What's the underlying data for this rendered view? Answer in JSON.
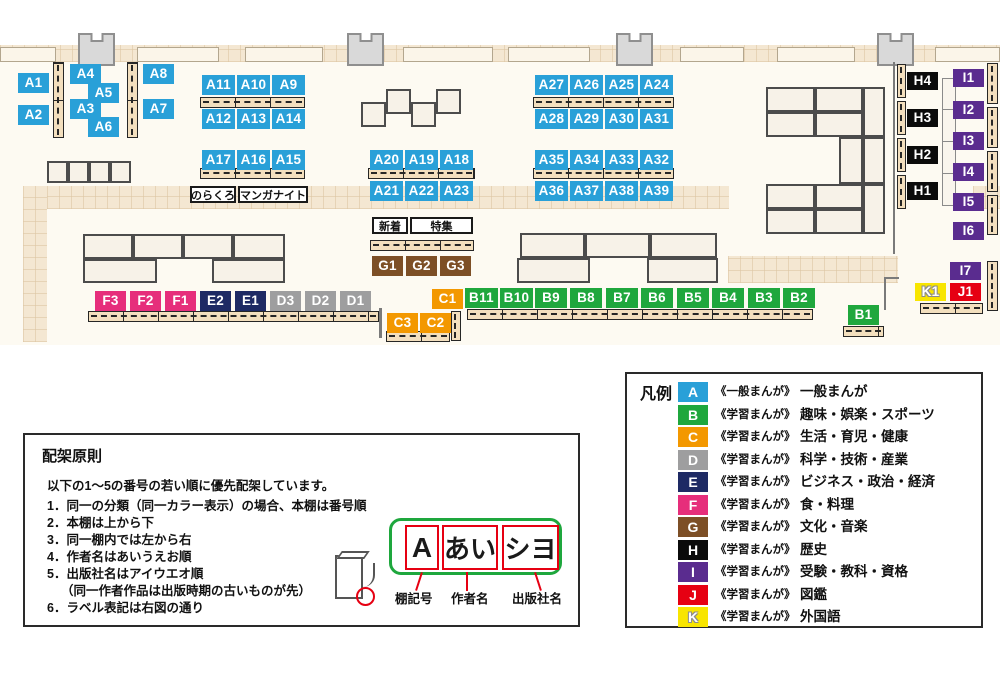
{
  "colors": {
    "A": "#29a0d8",
    "B": "#1fa73d",
    "C": "#f39800",
    "D": "#9e9e9f",
    "E": "#1e2a64",
    "F": "#e62e7b",
    "G": "#7d4f26",
    "H": "#0b0b0b",
    "I": "#5a2c8f",
    "J": "#e60012",
    "K": "#f8e500"
  },
  "map": {
    "markers": [
      {
        "t": "A1",
        "c": "A",
        "x": 18,
        "y": 73
      },
      {
        "t": "A2",
        "c": "A",
        "x": 18,
        "y": 105
      },
      {
        "t": "A4",
        "c": "A",
        "x": 70,
        "y": 64
      },
      {
        "t": "A5",
        "c": "A",
        "x": 88,
        "y": 83
      },
      {
        "t": "A3",
        "c": "A",
        "x": 70,
        "y": 99
      },
      {
        "t": "A6",
        "c": "A",
        "x": 88,
        "y": 117
      },
      {
        "t": "A8",
        "c": "A",
        "x": 143,
        "y": 64
      },
      {
        "t": "A7",
        "c": "A",
        "x": 143,
        "y": 99
      },
      {
        "t": "A11",
        "c": "A",
        "x": 202,
        "y": 75,
        "w": 33
      },
      {
        "t": "A10",
        "c": "A",
        "x": 237,
        "y": 75,
        "w": 33
      },
      {
        "t": "A9",
        "c": "A",
        "x": 272,
        "y": 75,
        "w": 33
      },
      {
        "t": "A12",
        "c": "A",
        "x": 202,
        "y": 109,
        "w": 33
      },
      {
        "t": "A13",
        "c": "A",
        "x": 237,
        "y": 109,
        "w": 33
      },
      {
        "t": "A14",
        "c": "A",
        "x": 272,
        "y": 109,
        "w": 33
      },
      {
        "t": "A17",
        "c": "A",
        "x": 202,
        "y": 150,
        "w": 33
      },
      {
        "t": "A16",
        "c": "A",
        "x": 237,
        "y": 150,
        "w": 33
      },
      {
        "t": "A15",
        "c": "A",
        "x": 272,
        "y": 150,
        "w": 33
      },
      {
        "t": "A20",
        "c": "A",
        "x": 370,
        "y": 150,
        "w": 33
      },
      {
        "t": "A19",
        "c": "A",
        "x": 405,
        "y": 150,
        "w": 33
      },
      {
        "t": "A18",
        "c": "A",
        "x": 440,
        "y": 150,
        "w": 33
      },
      {
        "t": "A21",
        "c": "A",
        "x": 370,
        "y": 181,
        "w": 33
      },
      {
        "t": "A22",
        "c": "A",
        "x": 405,
        "y": 181,
        "w": 33
      },
      {
        "t": "A23",
        "c": "A",
        "x": 440,
        "y": 181,
        "w": 33
      },
      {
        "t": "A27",
        "c": "A",
        "x": 535,
        "y": 75,
        "w": 33
      },
      {
        "t": "A26",
        "c": "A",
        "x": 570,
        "y": 75,
        "w": 33
      },
      {
        "t": "A25",
        "c": "A",
        "x": 605,
        "y": 75,
        "w": 33
      },
      {
        "t": "A24",
        "c": "A",
        "x": 640,
        "y": 75,
        "w": 33
      },
      {
        "t": "A28",
        "c": "A",
        "x": 535,
        "y": 109,
        "w": 33
      },
      {
        "t": "A29",
        "c": "A",
        "x": 570,
        "y": 109,
        "w": 33
      },
      {
        "t": "A30",
        "c": "A",
        "x": 605,
        "y": 109,
        "w": 33
      },
      {
        "t": "A31",
        "c": "A",
        "x": 640,
        "y": 109,
        "w": 33
      },
      {
        "t": "A35",
        "c": "A",
        "x": 535,
        "y": 150,
        "w": 33
      },
      {
        "t": "A34",
        "c": "A",
        "x": 570,
        "y": 150,
        "w": 33
      },
      {
        "t": "A33",
        "c": "A",
        "x": 605,
        "y": 150,
        "w": 33
      },
      {
        "t": "A32",
        "c": "A",
        "x": 640,
        "y": 150,
        "w": 33
      },
      {
        "t": "A36",
        "c": "A",
        "x": 535,
        "y": 181,
        "w": 33
      },
      {
        "t": "A37",
        "c": "A",
        "x": 570,
        "y": 181,
        "w": 33
      },
      {
        "t": "A38",
        "c": "A",
        "x": 605,
        "y": 181,
        "w": 33
      },
      {
        "t": "A39",
        "c": "A",
        "x": 640,
        "y": 181,
        "w": 33
      },
      {
        "t": "G1",
        "c": "G",
        "x": 372,
        "y": 256
      },
      {
        "t": "G2",
        "c": "G",
        "x": 406,
        "y": 256
      },
      {
        "t": "G3",
        "c": "G",
        "x": 440,
        "y": 256
      },
      {
        "t": "F3",
        "c": "F",
        "x": 95,
        "y": 291
      },
      {
        "t": "F2",
        "c": "F",
        "x": 130,
        "y": 291
      },
      {
        "t": "F1",
        "c": "F",
        "x": 165,
        "y": 291
      },
      {
        "t": "E2",
        "c": "E",
        "x": 200,
        "y": 291
      },
      {
        "t": "E1",
        "c": "E",
        "x": 235,
        "y": 291
      },
      {
        "t": "D3",
        "c": "D",
        "x": 270,
        "y": 291
      },
      {
        "t": "D2",
        "c": "D",
        "x": 305,
        "y": 291
      },
      {
        "t": "D1",
        "c": "D",
        "x": 340,
        "y": 291
      },
      {
        "t": "C1",
        "c": "C",
        "x": 432,
        "y": 289
      },
      {
        "t": "C3",
        "c": "C",
        "x": 387,
        "y": 313
      },
      {
        "t": "C2",
        "c": "C",
        "x": 420,
        "y": 313
      },
      {
        "t": "B11",
        "c": "B",
        "x": 465,
        "y": 288,
        "w": 33
      },
      {
        "t": "B10",
        "c": "B",
        "x": 500,
        "y": 288,
        "w": 33
      },
      {
        "t": "B9",
        "c": "B",
        "x": 535,
        "y": 288,
        "w": 32
      },
      {
        "t": "B8",
        "c": "B",
        "x": 570,
        "y": 288,
        "w": 32
      },
      {
        "t": "B7",
        "c": "B",
        "x": 606,
        "y": 288,
        "w": 32
      },
      {
        "t": "B6",
        "c": "B",
        "x": 641,
        "y": 288,
        "w": 32
      },
      {
        "t": "B5",
        "c": "B",
        "x": 677,
        "y": 288,
        "w": 32
      },
      {
        "t": "B4",
        "c": "B",
        "x": 712,
        "y": 288,
        "w": 32
      },
      {
        "t": "B3",
        "c": "B",
        "x": 748,
        "y": 288,
        "w": 32
      },
      {
        "t": "B2",
        "c": "B",
        "x": 783,
        "y": 288,
        "w": 32
      },
      {
        "t": "B1",
        "c": "B",
        "x": 848,
        "y": 305
      },
      {
        "t": "H4",
        "c": "H",
        "x": 907,
        "y": 72,
        "h": 18
      },
      {
        "t": "H3",
        "c": "H",
        "x": 907,
        "y": 109,
        "h": 18
      },
      {
        "t": "H2",
        "c": "H",
        "x": 907,
        "y": 146,
        "h": 18
      },
      {
        "t": "H1",
        "c": "H",
        "x": 907,
        "y": 182,
        "h": 18
      },
      {
        "t": "I1",
        "c": "I",
        "x": 953,
        "y": 69,
        "h": 18
      },
      {
        "t": "I2",
        "c": "I",
        "x": 953,
        "y": 101,
        "h": 18
      },
      {
        "t": "I3",
        "c": "I",
        "x": 953,
        "y": 132,
        "h": 18
      },
      {
        "t": "I4",
        "c": "I",
        "x": 953,
        "y": 163,
        "h": 18
      },
      {
        "t": "I5",
        "c": "I",
        "x": 953,
        "y": 193,
        "h": 18
      },
      {
        "t": "I6",
        "c": "I",
        "x": 953,
        "y": 222,
        "h": 18
      },
      {
        "t": "I7",
        "c": "I",
        "x": 950,
        "y": 262,
        "h": 18
      },
      {
        "t": "K1",
        "c": "K",
        "x": 915,
        "y": 283,
        "h": 18
      },
      {
        "t": "J1",
        "c": "J",
        "x": 950,
        "y": 283,
        "h": 18
      }
    ],
    "callouts": [
      {
        "id": "norakuro",
        "text": "のらくろ",
        "x": 190,
        "y": 186,
        "w": 46,
        "h": 17
      },
      {
        "id": "manga-night",
        "text": "マンガナイト",
        "x": 238,
        "y": 186,
        "w": 70,
        "h": 17
      },
      {
        "id": "shinchaku",
        "text": "新着",
        "x": 372,
        "y": 217,
        "w": 36,
        "h": 17
      },
      {
        "id": "tokushu",
        "text": "特集",
        "x": 410,
        "y": 217,
        "w": 63,
        "h": 17
      }
    ]
  },
  "principles": {
    "title": "配架原則",
    "intro": "以下の1～5の番号の若い順に優先配架しています。",
    "items": [
      "1．同一の分類（同一カラー表示）の場合、本棚は番号順",
      "2．本棚は上から下",
      "3．同一棚内では左から右",
      "4．作者名はあいうえお順",
      "5．出版社名はアイウエオ順",
      "（同一作者作品は出版時期の古いものが先）",
      "6．ラベル表記は右図の通り"
    ],
    "label_example": {
      "shelf_code": "A",
      "author": "あい",
      "publisher": "シヨ"
    },
    "captions": [
      "棚記号",
      "作者名",
      "出版社名"
    ]
  },
  "legend": {
    "title": "凡例",
    "rows": [
      {
        "letter": "A",
        "type": "《一般まんが》",
        "category": "一般まんが"
      },
      {
        "letter": "B",
        "type": "《学習まんが》",
        "category": "趣味・娯楽・スポーツ"
      },
      {
        "letter": "C",
        "type": "《学習まんが》",
        "category": "生活・育児・健康"
      },
      {
        "letter": "D",
        "type": "《学習まんが》",
        "category": "科学・技術・産業"
      },
      {
        "letter": "E",
        "type": "《学習まんが》",
        "category": "ビジネス・政治・経済"
      },
      {
        "letter": "F",
        "type": "《学習まんが》",
        "category": "食・料理"
      },
      {
        "letter": "G",
        "type": "《学習まんが》",
        "category": "文化・音楽"
      },
      {
        "letter": "H",
        "type": "《学習まんが》",
        "category": "歴史"
      },
      {
        "letter": "I",
        "type": "《学習まんが》",
        "category": "受験・教科・資格"
      },
      {
        "letter": "J",
        "type": "《学習まんが》",
        "category": "図鑑"
      },
      {
        "letter": "K",
        "type": "《学習まんが》",
        "category": "外国語"
      }
    ]
  }
}
